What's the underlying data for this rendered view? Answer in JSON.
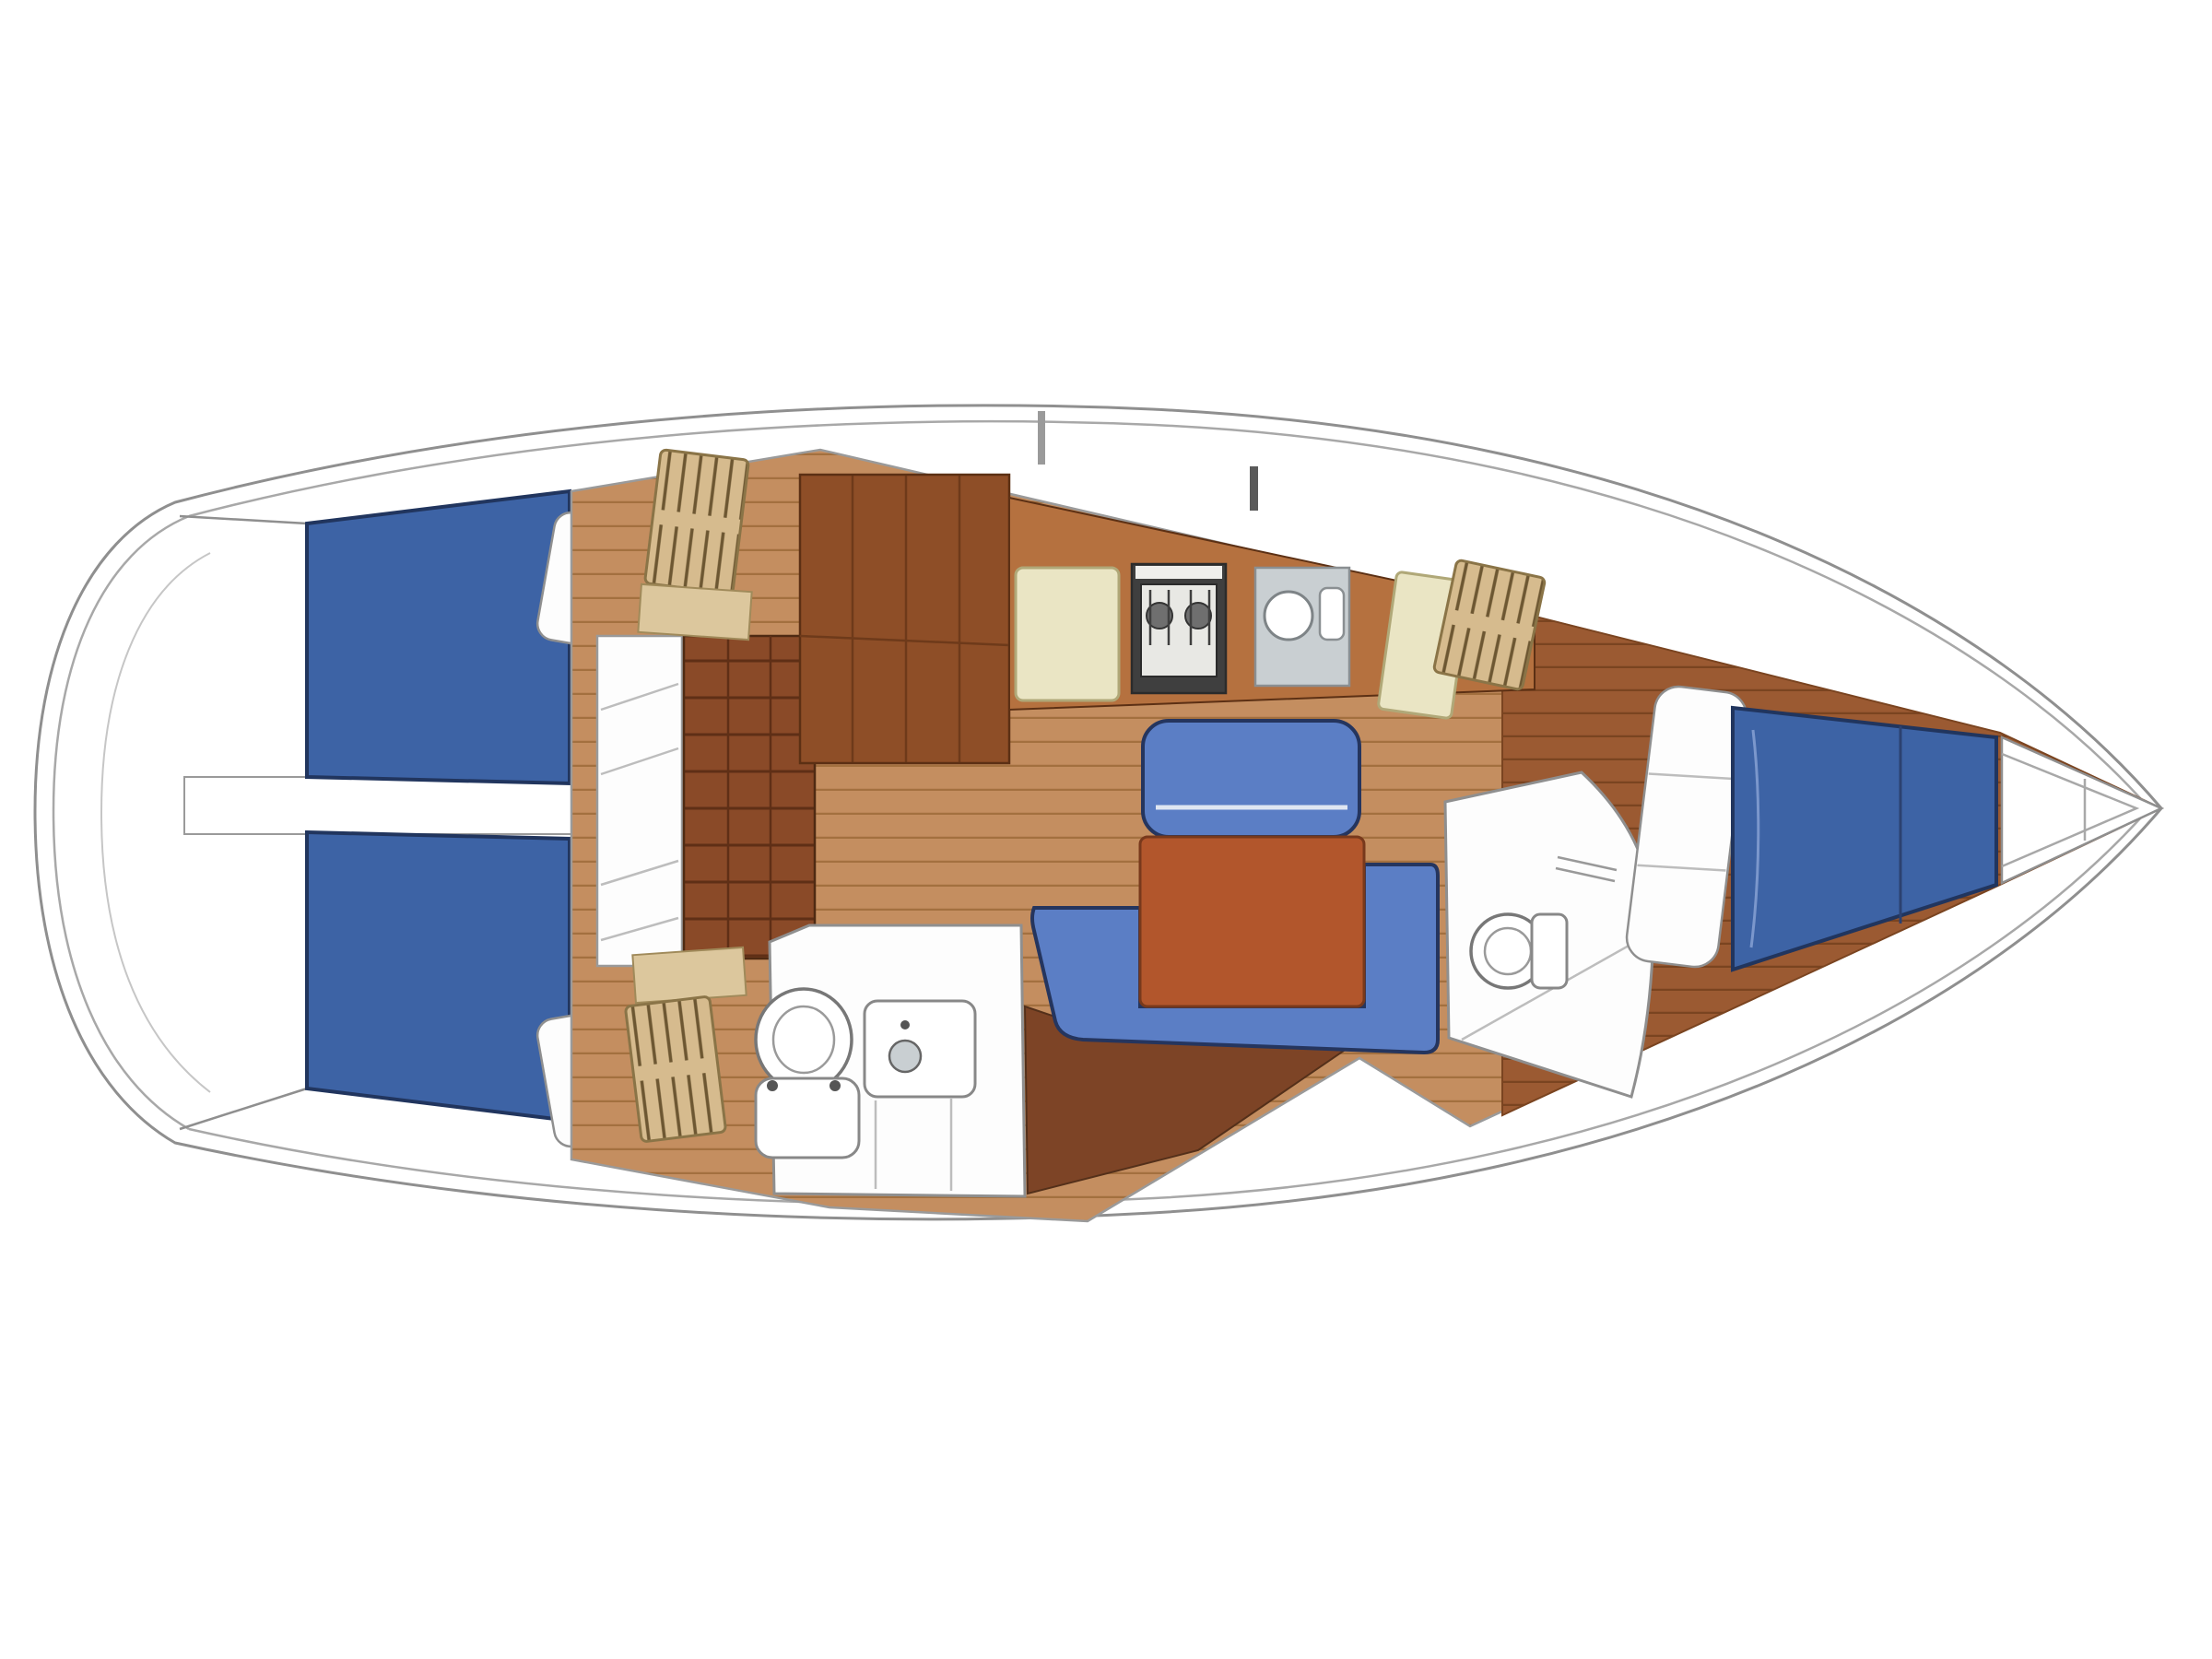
{
  "meta": {
    "title": "Sailboat interior layout floor plan",
    "view": "top-down deck plan",
    "orientation": "bow to the right, stern to the left",
    "text_content": "none — drawing only"
  },
  "colors": {
    "page_bg": "#ffffff",
    "hull_fill": "#ffffff",
    "hull_outline": "#8f8f8f",
    "berth_blue": "#3d63a5",
    "berth_outline": "#21355e",
    "settee_blue": "#5b7ec5",
    "table_orange": "#b2562c",
    "table_border": "#78391c",
    "floor_wood": "#c48e60",
    "floor_plank_line": "#a3703f",
    "forepeak_wood": "#9b5a32",
    "forepeak_plank_line": "#7a4420",
    "counter_wood": "#b5713f",
    "cabinet_wood": "#8e4e27",
    "cabinet_panel_line": "#6e3a1a",
    "ladder_wood": "#8a4a28",
    "ladder_rung_line": "#5f2f16",
    "wedge_wood": "#7d4426",
    "locker_tan": "#d6bb8e",
    "locker_stripe": "#6d5732",
    "shelf_tan": "#dcc79d",
    "cream_hatch": "#eae5c4",
    "cream_border": "#b0a878",
    "stove_frame": "#3f3f3f",
    "stove_inner": "#e8e8e4",
    "burner_gray": "#6f6f6f",
    "sink_gray": "#c9cfd2",
    "fixture_white": "#fdfdfd",
    "fixture_outline": "#8f8f8f"
  },
  "features": [
    {
      "id": "transom",
      "label": "Rounded stern with swim platform arcs"
    },
    {
      "id": "aft-cabin-port",
      "label": "Aft double cabin (top) with blue berth, pillow, shelves and hanging locker"
    },
    {
      "id": "aft-cabin-stbd",
      "label": "Aft double cabin (bottom) with blue berth, pillow, shelves and hanging locker"
    },
    {
      "id": "companionway",
      "label": "Companionway steps and engine box between aft cabins"
    },
    {
      "id": "galley",
      "label": "Galley along coachroof: icebox lid, stove, round sink, worktop hatch"
    },
    {
      "id": "saloon",
      "label": "Saloon with straight bench, orange table and U-shaped blue settee"
    },
    {
      "id": "aft-head",
      "label": "Aft heads compartment with toilet, washbasin and shower"
    },
    {
      "id": "fwd-head",
      "label": "Forward heads compartment with toilet and curved shower wall"
    },
    {
      "id": "v-berth",
      "label": "Forward V-berth with blue mattress and white pillows"
    },
    {
      "id": "bow-locker",
      "label": "Anchor locker in the bow tip"
    },
    {
      "id": "cabin-sole",
      "label": "Wood plank cabin sole"
    },
    {
      "id": "mast-post",
      "label": "Mast / compression post marks"
    }
  ]
}
